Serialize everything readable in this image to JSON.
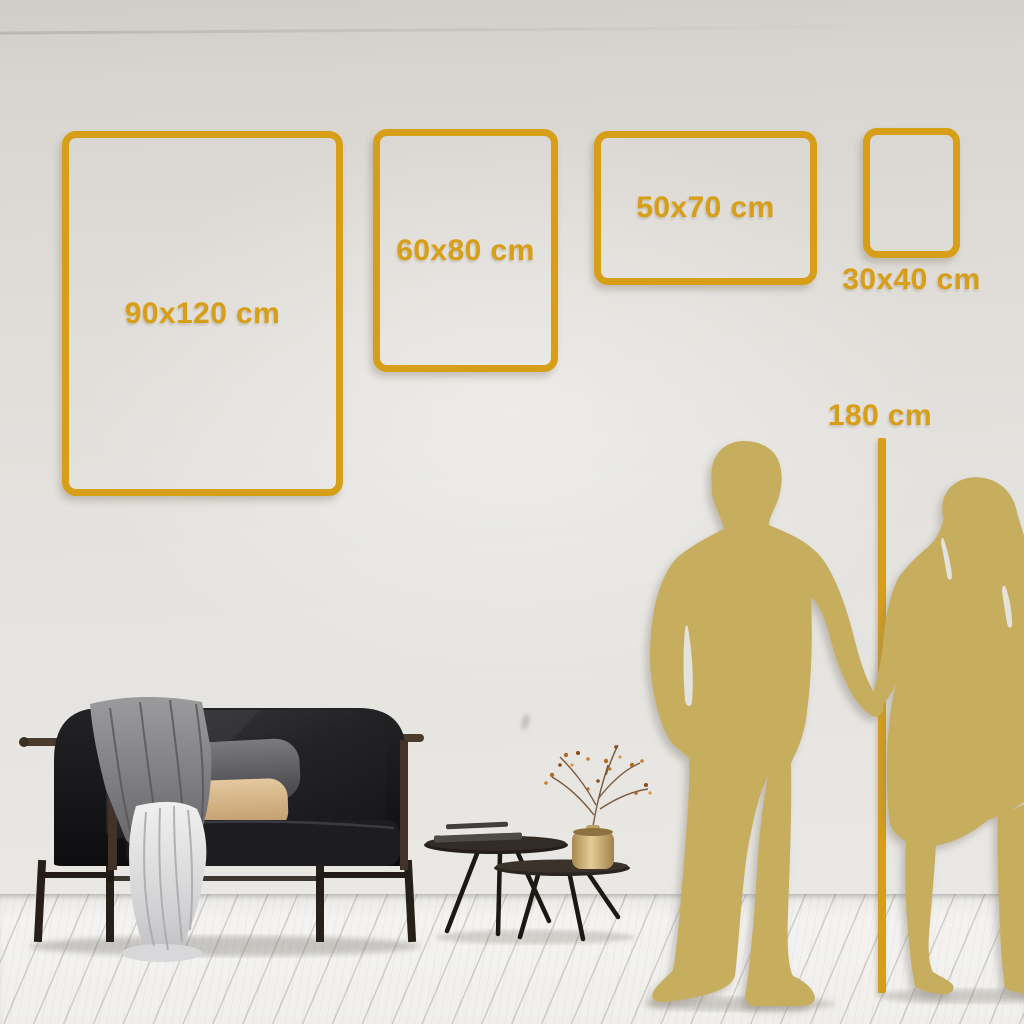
{
  "size_guide": {
    "frames": [
      {
        "id": "frame-90x120",
        "label": "90x120 cm",
        "width_cm": 90,
        "height_cm": 120
      },
      {
        "id": "frame-60x80",
        "label": "60x80 cm",
        "width_cm": 60,
        "height_cm": 80
      },
      {
        "id": "frame-50x70",
        "label": "50x70 cm",
        "width_cm": 50,
        "height_cm": 70
      },
      {
        "id": "frame-30x40",
        "label": "30x40 cm",
        "width_cm": 30,
        "height_cm": 40
      }
    ],
    "height_marker": {
      "label": "180 cm",
      "value_cm": 180
    }
  },
  "colors": {
    "accent_gold": "#d79e17",
    "silhouette_gold": "#c7ae5e",
    "wall": "#e2dfda",
    "floor": "#f2f1ef",
    "sofa_dark": "#17171a",
    "pillow_tan": "#d8b988",
    "vase_brass": "#c9a96b"
  },
  "scene_objects": [
    "dark velvet sofa with gray blanket, gray pillow, tan pillow and white draped cloth",
    "two nesting round coffee tables with stacked books and brass vase holding a dried berry branch",
    "gold silhouette of a couple holding hands beside the 180 cm height line"
  ]
}
